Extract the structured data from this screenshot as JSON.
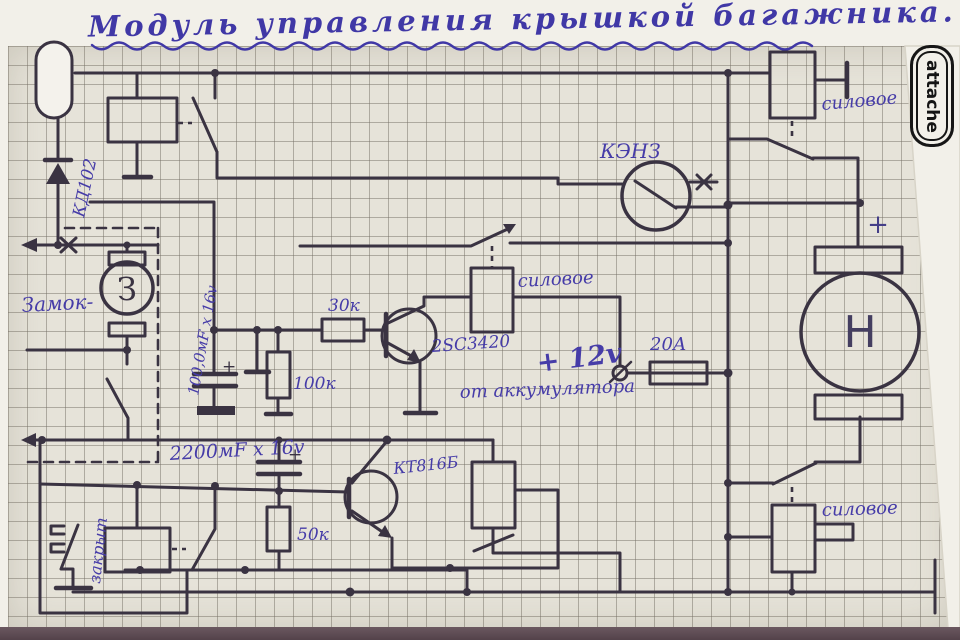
{
  "title": "Модуль управления крышкой багажника.",
  "brand": "attache",
  "colors": {
    "ink_blue": "#4038a6",
    "ink_dark": "#3a3342",
    "paper": "#e6e3d9"
  },
  "components": {
    "diode": "КД102",
    "lock_label": "Замок-",
    "lock_motor": "З",
    "relay_kenz": "КЭНЗ",
    "power_relay_top": "силовое",
    "power_relay_mid": "силовое",
    "power_relay_bottom": "силовое",
    "resistor_30k": "30к",
    "resistor_100k": "100к",
    "resistor_50k": "50к",
    "transistor_npn": "2SC3420",
    "transistor_kt816": "КТ816Б",
    "cap_100uf": "100,0мF х 16v",
    "cap_2200uf": "2200мF х 16v",
    "cap_plus_1": "+",
    "cap_plus_2": "+",
    "supply_voltage": "+ 12v",
    "supply_source": "от аккумулятора",
    "fuse_20a": "20А",
    "pump_motor": "Н",
    "motor_plus": "+",
    "limit_switch_closed": "закрыт"
  }
}
